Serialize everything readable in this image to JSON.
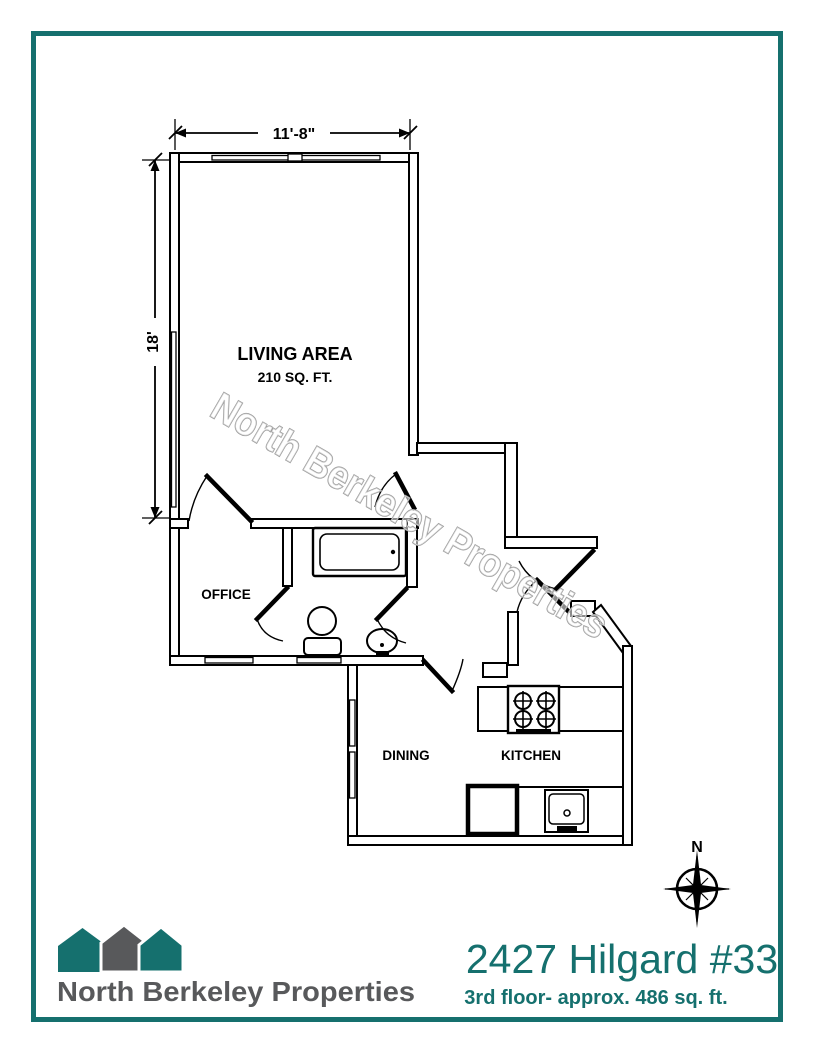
{
  "page": {
    "border_color": "#15706e",
    "background": "#ffffff"
  },
  "floor_plan": {
    "line_color": "#000000",
    "watermark": "North Berkeley Properties",
    "watermark_color": "#9a9a9a",
    "dimensions": {
      "width": "11'-8\"",
      "height": "18'"
    },
    "rooms": {
      "living_area": {
        "label": "LIVING AREA",
        "area": "210 SQ. FT."
      },
      "office": {
        "label": "OFFICE"
      },
      "dining": {
        "label": "DINING"
      },
      "kitchen": {
        "label": "KITCHEN"
      }
    },
    "fixtures": [
      "bathtub",
      "toilet",
      "bath-sink",
      "stove",
      "counter",
      "refrigerator",
      "kitchen-sink"
    ],
    "compass": {
      "label": "N"
    }
  },
  "footer": {
    "logo": {
      "company": "North Berkeley Properties",
      "teal": "#15706e",
      "gray": "#58595b"
    },
    "title": "2427 Hilgard #33",
    "subtitle": "3rd floor- approx. 486 sq. ft.",
    "accent_color": "#15706e"
  }
}
